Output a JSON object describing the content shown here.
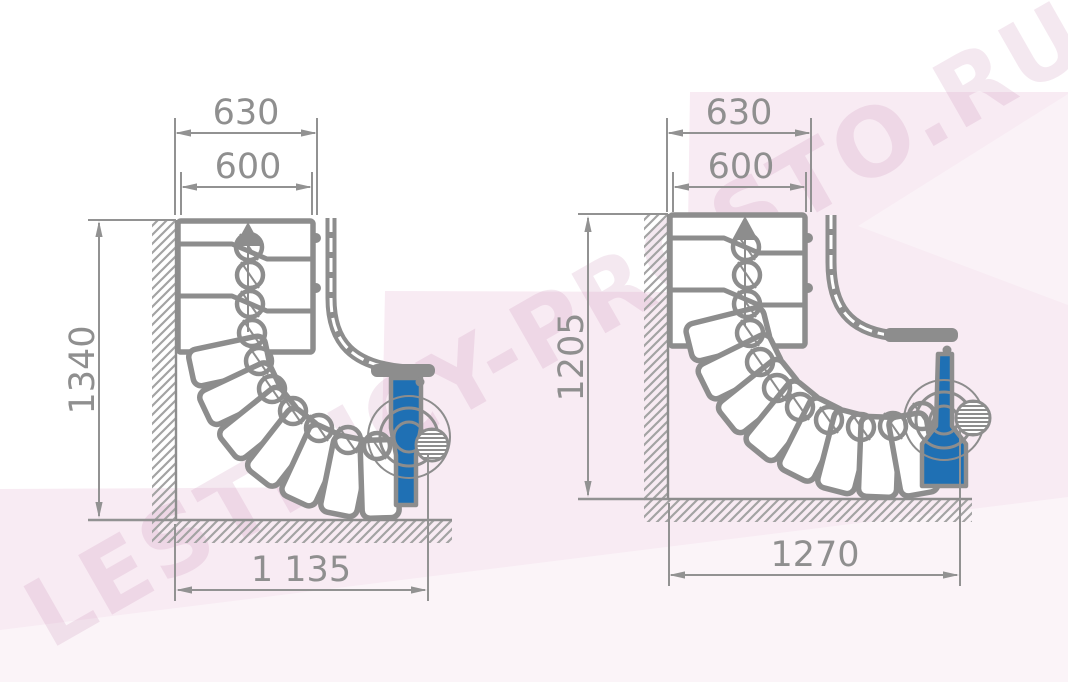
{
  "watermark": {
    "text": "LESTNICY-PROSTO.RU"
  },
  "drawings": {
    "left": {
      "dims": {
        "outer_width": "630",
        "tread_width": "600",
        "height": "1340",
        "total_width": "1 135"
      }
    },
    "right": {
      "dims": {
        "outer_width": "630",
        "tread_width": "600",
        "height": "1205",
        "total_width": "1270"
      }
    }
  },
  "colors": {
    "line_gray": "#8d8d8d",
    "dimension_gray": "#929292",
    "accent_blue": "#1f70b4",
    "background_pink": "#f8ebf3",
    "watermark_pink": "rgba(190,120,165,0.17)"
  }
}
